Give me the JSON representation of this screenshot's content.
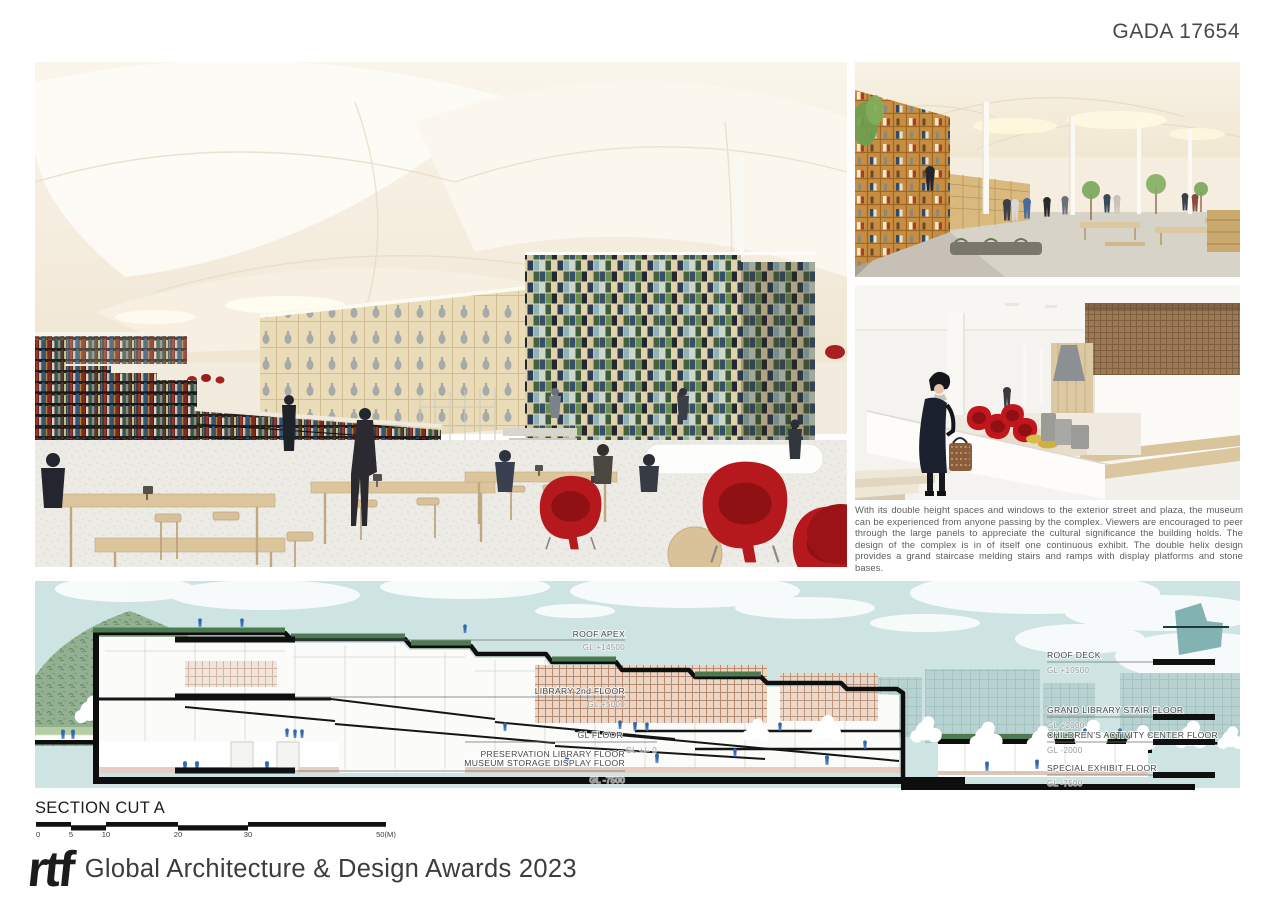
{
  "board": {
    "id_label": "GADA 17654"
  },
  "description": {
    "text": "With its double height spaces and windows to the exterior street and plaza, the museum can be experienced from anyone passing by the complex. Viewers are encouraged to peer through the large panels to appreciate the cultural significance the building holds. The design of the complex is in of itself one continuous exhibit. The double helix design provides a grand staircase melding stairs and ramps with display platforms and stone bases."
  },
  "section": {
    "title": "SECTION CUT A",
    "left_labels": [
      {
        "name": "ROOF APEX",
        "gl": "GL +14500"
      },
      {
        "name": "LIBRARY 2nd FLOOR",
        "gl": "GL +5000"
      },
      {
        "name": "GL FLOOR",
        "gl": "GL +/- 0"
      },
      {
        "name": "PRESERVATION LIBRARY FLOOR",
        "name2": "MUSEUM STORAGE DISPLAY FLOOR",
        "gl": "GL -7500"
      }
    ],
    "right_labels": [
      {
        "name": "ROOF DECK",
        "gl": "GL +10500"
      },
      {
        "name": "GRAND LIBRARY STAIR FLOOR",
        "gl": "GL +2000"
      },
      {
        "name": "CHILDREN'S ACTIVITY CENTER FLOOR",
        "gl": "GL -2000"
      },
      {
        "name": "SPECIAL EXHIBIT FLOOR",
        "gl": "GL -7500"
      }
    ],
    "scale_ticks": [
      "0",
      "5",
      "10",
      "20",
      "30",
      "50(M)"
    ]
  },
  "footer": {
    "logo_text": "rtf",
    "award_text": "Global Architecture & Design Awards 2023"
  },
  "images": {
    "main": "library-interior-rendering",
    "top_right": "reading-hall-rendering",
    "bottom_right": "stair-gallery-rendering",
    "section_drawing": "building-section-drawing"
  },
  "colors": {
    "sky": "#cde4e2",
    "figure_blue": "#3468ae",
    "accent_red": "#b5191d",
    "turf_green": "#4e7a52",
    "ink": "#111111"
  }
}
